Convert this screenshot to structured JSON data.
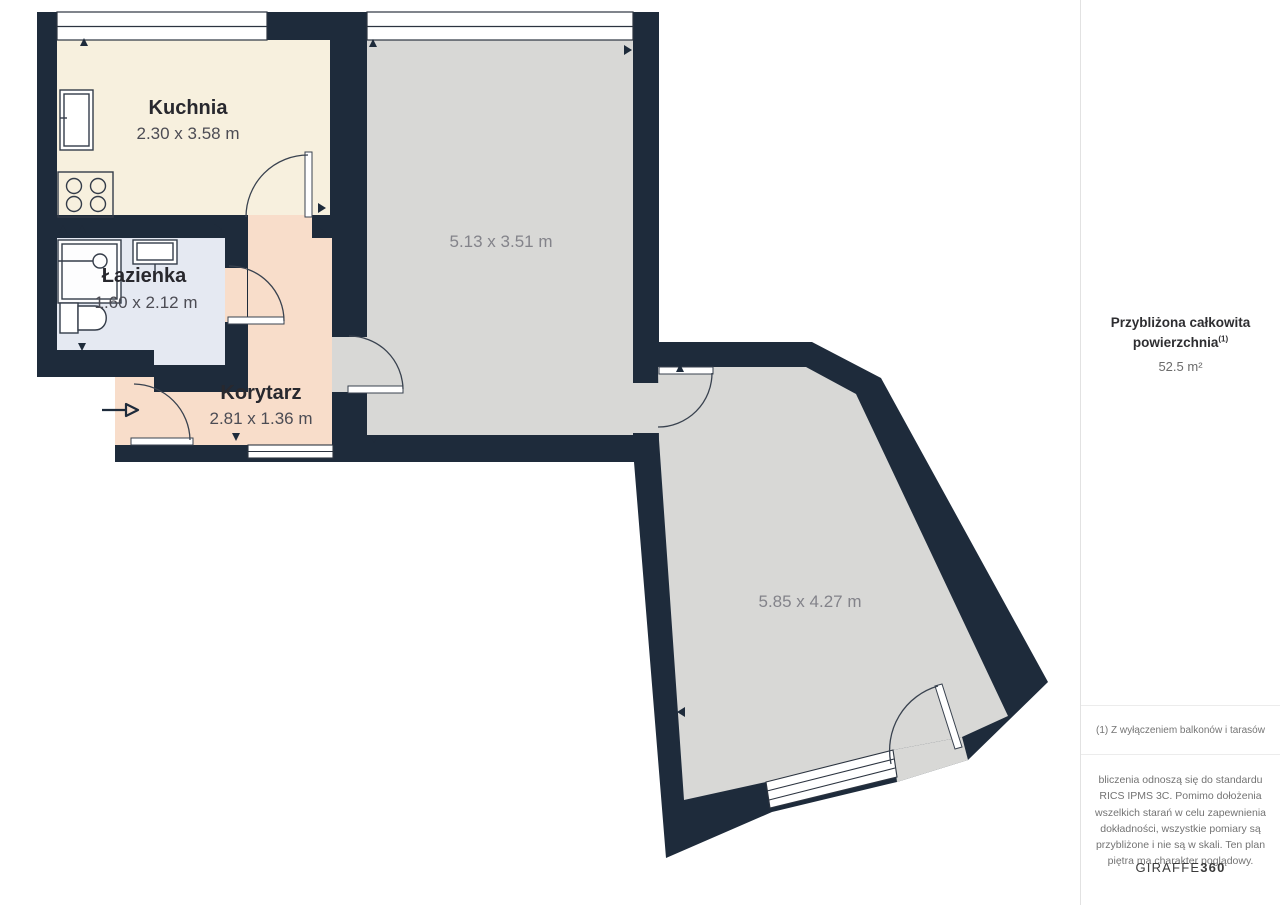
{
  "plan": {
    "rooms": [
      {
        "name": "Kuchnia",
        "dims": "2.30 x 3.58 m"
      },
      {
        "name": "Łazienka",
        "dims": "1.60 x 2.12 m"
      },
      {
        "name": "Korytarz",
        "dims": "2.81 x 1.36 m"
      },
      {
        "name": "",
        "dims": "5.13 x 3.51 m"
      },
      {
        "name": "",
        "dims": "5.85 x 4.27 m"
      }
    ],
    "colors": {
      "wall": "#1e2b3b",
      "kitchen": "#f7f0de",
      "bathroom": "#e5e9f2",
      "corridor": "#f8ddca",
      "room": "#d8d8d6",
      "background": "#ffffff"
    }
  },
  "sidebar": {
    "title_line1": "Przybliżona całkowita",
    "title_line2": "powierzchnia",
    "title_sup": "(1)",
    "area": "52.5 m²",
    "footnote": "(1) Z wyłączeniem balkonów i tarasów",
    "disclaimer": "bliczenia odnoszą się do standardu RICS IPMS 3C. Pomimo dołożenia wszelkich starań w celu zapewnienia dokładności, wszystkie pomiary są przybliżone i nie są w skali. Ten plan piętra ma charakter poglądowy.",
    "brand": {
      "regular": "GIRAFFE",
      "bold": "360"
    }
  }
}
